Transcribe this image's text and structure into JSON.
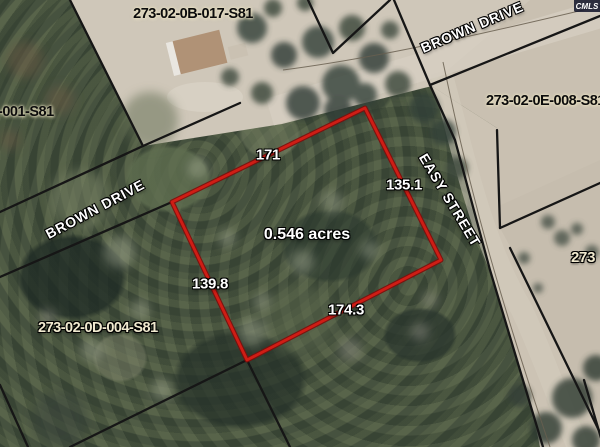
{
  "map": {
    "watermark": "CMLS",
    "parcel_ids": {
      "top": "273-02-0B-017-S81",
      "left_edge": "-001-S81",
      "right": "273-02-0E-008-S81",
      "bottom_left": "273-02-0D-004-S81",
      "right_edge": "273"
    },
    "street_names": {
      "brown_drive_upper": "BROWN DRIVE",
      "brown_drive_lower": "BROWN DRIVE",
      "easy_street": "EASY STREET"
    },
    "subject_parcel": {
      "area_label": "0.546 acres",
      "dimensions": {
        "top": "171",
        "right": "135.1",
        "left": "139.8",
        "bottom": "174.3"
      },
      "outline_color": "#cf1d15"
    }
  }
}
